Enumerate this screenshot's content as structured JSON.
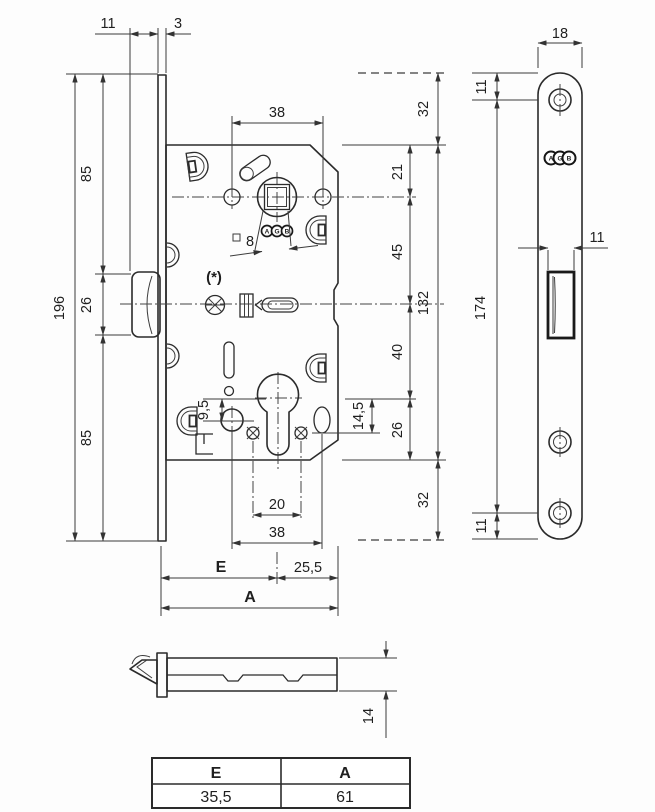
{
  "title": "Mortise lock technical drawing",
  "labels": {
    "latch_protrusion": "11",
    "plate_thickness": "3",
    "plate_total_height": "196",
    "plate_upper": "85",
    "latch_height": "26",
    "plate_lower": "85",
    "handle_spacing": "38",
    "square_size": "8",
    "note": "(*)",
    "top_to_axis": "21",
    "axis_to_latch": "45",
    "case_height": "132",
    "latch_to_cylinder": "40",
    "cylinder_hole_offset": "9,5",
    "screw_offset": "14,5",
    "cylinder_to_bottom": "26",
    "plate_overhang_top": "32",
    "plate_overhang_bottom": "32",
    "screw_spacing": "20",
    "bottom_hole_spacing": "38",
    "backset_label": "E",
    "axis_to_back": "25,5",
    "case_depth_label": "A",
    "faceplate_width": "18",
    "faceplate_top_to_screw": "11",
    "faceplate_screw_span": "174",
    "latch_window_width": "11",
    "faceplate_screw_to_bottom": "11",
    "case_thickness": "14"
  },
  "logo_letters": [
    "A",
    "G",
    "B"
  ],
  "table": {
    "headers": [
      "E",
      "A"
    ],
    "values": [
      "35,5",
      "61"
    ]
  }
}
